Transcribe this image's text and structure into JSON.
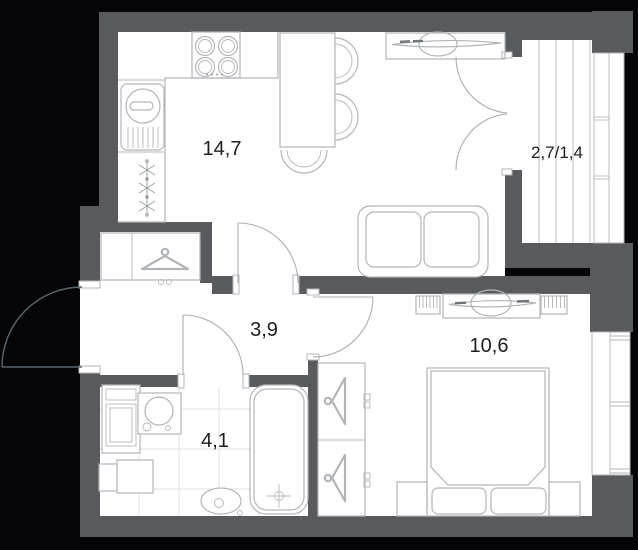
{
  "plan": {
    "type": "apartment-floor-plan",
    "units": "square-meters-comma-decimal",
    "rooms": [
      {
        "id": "kitchen-living",
        "label": "14,7"
      },
      {
        "id": "balcony",
        "label": "2,7/1,4"
      },
      {
        "id": "hallway",
        "label": "3,9"
      },
      {
        "id": "bathroom",
        "label": "4,1"
      },
      {
        "id": "bedroom",
        "label": "10,6"
      }
    ],
    "fixtures": [
      "stove-4-burners",
      "kitchen-sink",
      "fridge-snowflakes",
      "dining-table-3-chairs",
      "windowsill-console-decor",
      "sofa-2-seat",
      "balcony-french-door",
      "entry-door",
      "hallway-closet-hanger",
      "bathroom-door",
      "bedroom-door",
      "washing-machine",
      "bathroom-sink",
      "toilet",
      "bathtub-with-drain",
      "cabinet",
      "wardrobe-2-hangers",
      "radiator-left",
      "radiator-right",
      "dresser-console-decor",
      "double-bed-2-pillows",
      "nightstand-left",
      "nightstand-right",
      "bedroom-window",
      "balcony-glazing"
    ]
  },
  "colors": {
    "background": "#060608",
    "wall": "#595a5e",
    "floor": "#ffffff",
    "furn": "#b2b5b8",
    "arc": "#a9adb0",
    "extarc": "#5c666f",
    "tile": "#dfe1e2",
    "snow": "#9aa0a3",
    "dash": "#6e7478",
    "label": "#1c1c20"
  }
}
